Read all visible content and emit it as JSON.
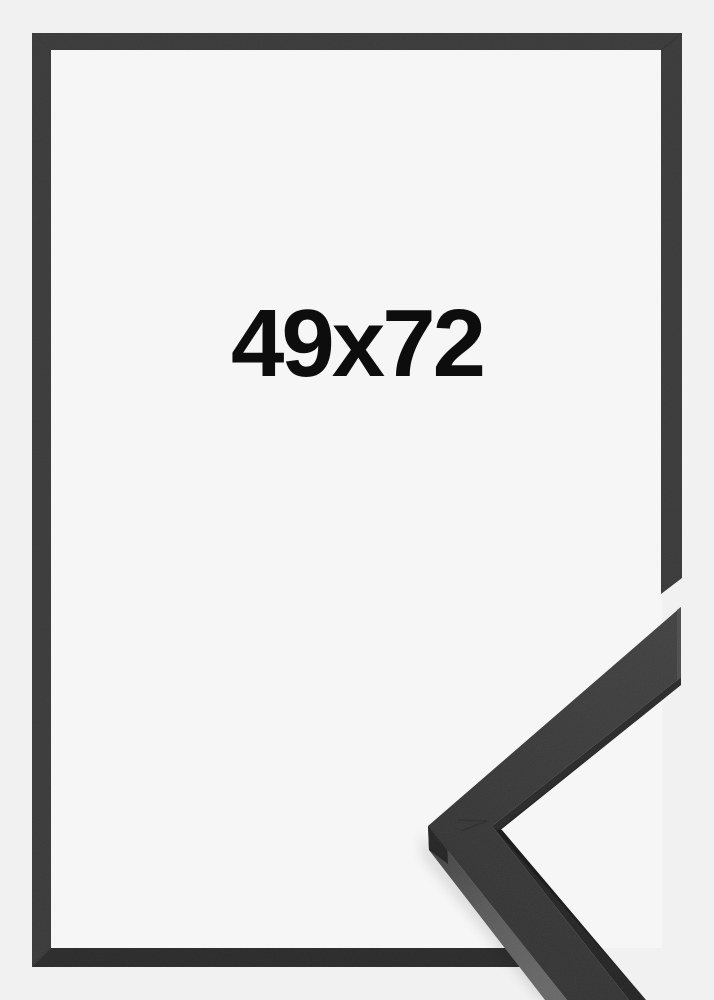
{
  "product": {
    "size_label": "49x72"
  },
  "image": {
    "description_elements": {
      "frame_front": "black picture frame shown flat, front view",
      "corner_profile": "3d corner sample of the frame moulding overlapping bottom-right"
    }
  },
  "colors": {
    "background_outer": "#f1f1f1",
    "background_inner": "#f6f6f6",
    "frame_border": "#363636",
    "frame_border_bottom": "#272727",
    "moulding_top_face": "#343434",
    "moulding_side_lit": "#585858",
    "moulding_side_dark": "#1e1e1e",
    "moulding_cut_face": "#484848",
    "label_text": "#0d0d0d"
  }
}
